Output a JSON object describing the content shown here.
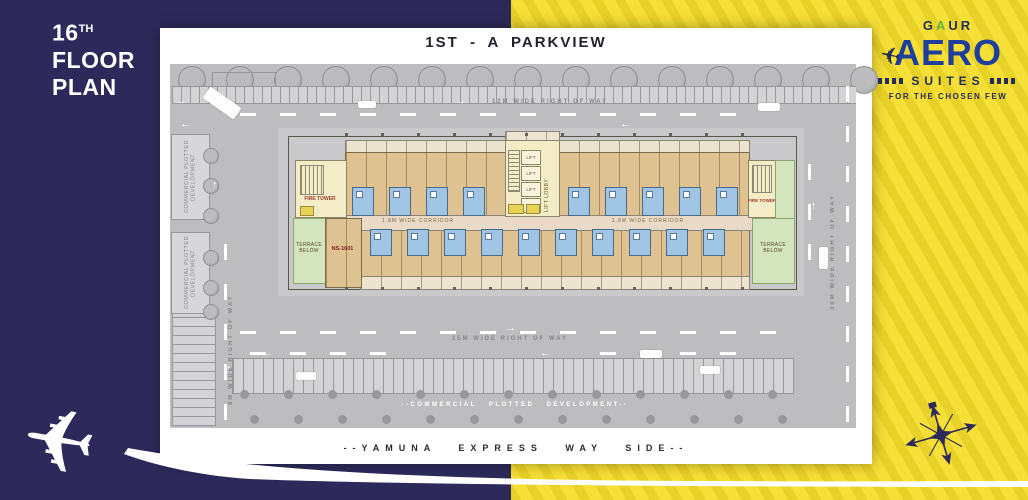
{
  "header": {
    "floor_number": "16",
    "floor_ordinal": "TH",
    "floor_word": "FLOOR",
    "plan_word": "PLAN"
  },
  "brand": {
    "gaur_g": "G",
    "gaur_a": "A",
    "gaur_ur": "UR",
    "product": "AERO",
    "suites": "SUITES",
    "tagline": "FOR THE CHOSEN FEW"
  },
  "plan": {
    "title": "1ST - A  PARKVIEW",
    "footer": "--YAMUNA EXPRESS WAY SIDE--",
    "roads": {
      "top": "12M WIDE RIGHT OF WAY",
      "middle": "15M WIDE RIGHT OF WAY",
      "left": "9M WIDE RIGHT OF WAY",
      "right": "30M WIDE RIGHT OF WAY"
    },
    "site": {
      "commercial_box": "COMMERCIAL PLOTTED DEVELOPMENT",
      "commercial_bottom": "--COMMERCIAL PLOTTED DEVELOPMENT--"
    },
    "building": {
      "terrace": "TERRACE BELOW",
      "fire_tower": "FIRE TOWER",
      "lift_lobby": "LIFT LOBBY",
      "lift": "LIFT",
      "corridor": "1.8M WIDE CORRIDOR",
      "unit_label": "NS-1601"
    }
  },
  "icons": {
    "airplane": "airplane-icon",
    "compass": "compass-rose-icon",
    "trees": "tree-icon"
  },
  "colors": {
    "navy": "#2d2a5b",
    "yellow": "#f5dd2a",
    "aero_blue": "#1d3e9c",
    "gaur_green": "#5cb347",
    "site_gray": "#bdbcbf",
    "unit_tan": "#dfc291",
    "bath_blue": "#9fc4e4",
    "terrace_green": "#d4e4bc",
    "core_cream": "#f3ecc6",
    "panel_white": "#ffffff"
  }
}
